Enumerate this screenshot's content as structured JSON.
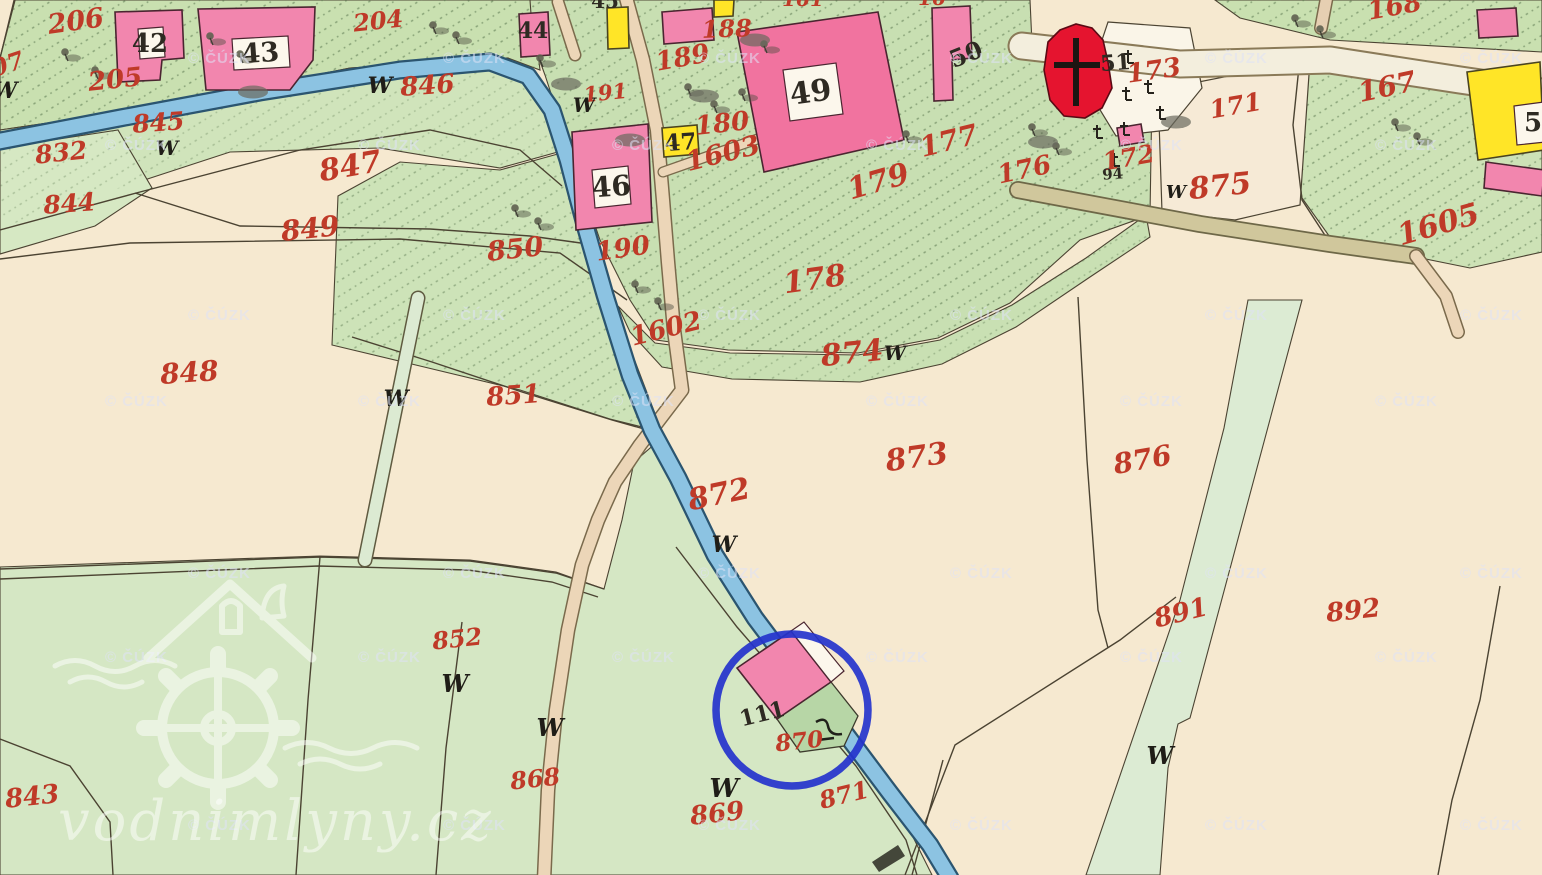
{
  "map": {
    "copyright_text": "© ČÚZK",
    "site_watermark": "vodnimlyny.cz",
    "palette": {
      "field_cream": "#f6e9d0",
      "meadow_green": "#d3e7c2",
      "garden_green": "#c9e0b0",
      "river_blue": "#8cc3e2",
      "road_beige": "#ecd6b8",
      "building_pink": "#f286ae",
      "building_yellow": "#ffe527",
      "church_red": "#e5142f",
      "label_red": "#bf3a28",
      "label_black": "#2e2a22",
      "highlight_blue": "#2433cc"
    },
    "labels": [
      {
        "t": "07",
        "x": 10,
        "y": 72,
        "s": 24,
        "r": -18,
        "c": "r"
      },
      {
        "t": "206",
        "x": 77,
        "y": 30,
        "s": 27,
        "r": -8,
        "c": "r"
      },
      {
        "t": "205",
        "x": 116,
        "y": 88,
        "s": 26,
        "r": -6,
        "c": "r"
      },
      {
        "t": "204",
        "x": 379,
        "y": 29,
        "s": 24,
        "r": -6,
        "c": "r"
      },
      {
        "t": "846",
        "x": 428,
        "y": 94,
        "s": 26,
        "r": -4,
        "c": "r"
      },
      {
        "t": "845",
        "x": 159,
        "y": 131,
        "s": 25,
        "r": -4,
        "c": "r"
      },
      {
        "t": "832",
        "x": 62,
        "y": 161,
        "s": 25,
        "r": -6,
        "c": "r"
      },
      {
        "t": "844",
        "x": 70,
        "y": 212,
        "s": 25,
        "r": -4,
        "c": "r"
      },
      {
        "t": "847",
        "x": 352,
        "y": 176,
        "s": 30,
        "r": -10,
        "c": "r"
      },
      {
        "t": "849",
        "x": 311,
        "y": 238,
        "s": 28,
        "r": -6,
        "c": "r"
      },
      {
        "t": "848",
        "x": 190,
        "y": 382,
        "s": 28,
        "r": -4,
        "c": "r"
      },
      {
        "t": "850",
        "x": 516,
        "y": 258,
        "s": 27,
        "r": -6,
        "c": "r"
      },
      {
        "t": "851",
        "x": 514,
        "y": 404,
        "s": 26,
        "r": -4,
        "c": "r"
      },
      {
        "t": "190",
        "x": 624,
        "y": 257,
        "s": 26,
        "r": -8,
        "c": "r"
      },
      {
        "t": "1602",
        "x": 668,
        "y": 337,
        "s": 26,
        "r": -14,
        "c": "r"
      },
      {
        "t": "189",
        "x": 684,
        "y": 66,
        "s": 26,
        "r": -10,
        "c": "r"
      },
      {
        "t": "191",
        "x": 606,
        "y": 100,
        "s": 21,
        "r": -6,
        "c": "r"
      },
      {
        "t": "188",
        "x": 727,
        "y": 37,
        "s": 24,
        "r": -2,
        "c": "r"
      },
      {
        "t": "180",
        "x": 723,
        "y": 132,
        "s": 26,
        "r": -6,
        "c": "r"
      },
      {
        "t": "1603",
        "x": 725,
        "y": 162,
        "s": 27,
        "r": -14,
        "c": "r"
      },
      {
        "t": "179",
        "x": 881,
        "y": 191,
        "s": 30,
        "r": -16,
        "c": "r"
      },
      {
        "t": "177",
        "x": 951,
        "y": 150,
        "s": 28,
        "r": -14,
        "c": "r"
      },
      {
        "t": "176",
        "x": 1026,
        "y": 178,
        "s": 26,
        "r": -12,
        "c": "r"
      },
      {
        "t": "178",
        "x": 816,
        "y": 289,
        "s": 30,
        "r": -8,
        "c": "r"
      },
      {
        "t": "173",
        "x": 1155,
        "y": 79,
        "s": 26,
        "r": -8,
        "c": "r"
      },
      {
        "t": "172",
        "x": 1130,
        "y": 166,
        "s": 25,
        "r": -10,
        "c": "r"
      },
      {
        "t": "171",
        "x": 1237,
        "y": 114,
        "s": 25,
        "r": -10,
        "c": "r"
      },
      {
        "t": "875",
        "x": 1221,
        "y": 196,
        "s": 30,
        "r": -6,
        "c": "r"
      },
      {
        "t": "167",
        "x": 1389,
        "y": 96,
        "s": 28,
        "r": -12,
        "c": "r"
      },
      {
        "t": "168",
        "x": 1396,
        "y": 15,
        "s": 26,
        "r": -10,
        "c": "r"
      },
      {
        "t": "1605",
        "x": 1441,
        "y": 234,
        "s": 30,
        "r": -16,
        "c": "r"
      },
      {
        "t": "874",
        "x": 853,
        "y": 363,
        "s": 30,
        "r": -6,
        "c": "r"
      },
      {
        "t": "873",
        "x": 918,
        "y": 467,
        "s": 30,
        "r": -8,
        "c": "r"
      },
      {
        "t": "872",
        "x": 721,
        "y": 504,
        "s": 30,
        "r": -12,
        "c": "r"
      },
      {
        "t": "876",
        "x": 1144,
        "y": 469,
        "s": 28,
        "r": -10,
        "c": "r"
      },
      {
        "t": "891",
        "x": 1183,
        "y": 621,
        "s": 26,
        "r": -14,
        "c": "r"
      },
      {
        "t": "892",
        "x": 1354,
        "y": 619,
        "s": 26,
        "r": -6,
        "c": "r"
      },
      {
        "t": "852",
        "x": 458,
        "y": 647,
        "s": 24,
        "r": -6,
        "c": "r"
      },
      {
        "t": "868",
        "x": 536,
        "y": 787,
        "s": 24,
        "r": -6,
        "c": "r"
      },
      {
        "t": "869",
        "x": 718,
        "y": 822,
        "s": 26,
        "r": -6,
        "c": "r"
      },
      {
        "t": "870",
        "x": 800,
        "y": 749,
        "s": 23,
        "r": -6,
        "c": "r"
      },
      {
        "t": "871",
        "x": 846,
        "y": 803,
        "s": 24,
        "r": -14,
        "c": "r"
      },
      {
        "t": "843",
        "x": 33,
        "y": 805,
        "s": 26,
        "r": -6,
        "c": "r"
      },
      {
        "t": "161",
        "x": 803,
        "y": 6,
        "s": 20,
        "r": 0,
        "c": "r"
      },
      {
        "t": "16",
        "x": 932,
        "y": 5,
        "s": 20,
        "r": 0,
        "c": "r"
      },
      {
        "t": "42",
        "x": 150,
        "y": 52,
        "s": 26,
        "r": 0,
        "c": "k"
      },
      {
        "t": "43",
        "x": 261,
        "y": 62,
        "s": 27,
        "r": -4,
        "c": "k"
      },
      {
        "t": "44",
        "x": 533,
        "y": 38,
        "s": 22,
        "r": 0,
        "c": "k"
      },
      {
        "t": "45",
        "x": 605,
        "y": 8,
        "s": 20,
        "r": 0,
        "c": "k"
      },
      {
        "t": "46",
        "x": 612,
        "y": 196,
        "s": 28,
        "r": -4,
        "c": "k"
      },
      {
        "t": "47",
        "x": 681,
        "y": 150,
        "s": 23,
        "r": -4,
        "c": "k"
      },
      {
        "t": "49",
        "x": 812,
        "y": 102,
        "s": 30,
        "r": -8,
        "c": "k"
      },
      {
        "t": "50",
        "x": 969,
        "y": 62,
        "s": 24,
        "r": -22,
        "c": "k"
      },
      {
        "t": "51",
        "x": 1116,
        "y": 70,
        "s": 22,
        "r": -4,
        "c": "k"
      },
      {
        "t": "5",
        "x": 1533,
        "y": 131,
        "s": 26,
        "r": 0,
        "c": "k"
      },
      {
        "t": "94",
        "x": 1113,
        "y": 179,
        "s": 15,
        "r": -4,
        "c": "k"
      },
      {
        "t": "111",
        "x": 764,
        "y": 721,
        "s": 22,
        "r": -14,
        "c": "k"
      },
      {
        "t": "W",
        "x": 5,
        "y": 98,
        "s": 22,
        "r": 0,
        "c": "w"
      },
      {
        "t": "W",
        "x": 167,
        "y": 155,
        "s": 20,
        "r": 0,
        "c": "w"
      },
      {
        "t": "W",
        "x": 380,
        "y": 93,
        "s": 22,
        "r": 0,
        "c": "w"
      },
      {
        "t": "W",
        "x": 584,
        "y": 112,
        "s": 20,
        "r": 0,
        "c": "w"
      },
      {
        "t": "W",
        "x": 396,
        "y": 406,
        "s": 22,
        "r": 0,
        "c": "w"
      },
      {
        "t": "W",
        "x": 895,
        "y": 360,
        "s": 20,
        "r": 0,
        "c": "w"
      },
      {
        "t": "W",
        "x": 1176,
        "y": 198,
        "s": 18,
        "r": 0,
        "c": "w"
      },
      {
        "t": "W",
        "x": 724,
        "y": 552,
        "s": 22,
        "r": 0,
        "c": "w"
      },
      {
        "t": "W",
        "x": 455,
        "y": 692,
        "s": 24,
        "r": 0,
        "c": "w"
      },
      {
        "t": "W",
        "x": 550,
        "y": 736,
        "s": 24,
        "r": 0,
        "c": "w"
      },
      {
        "t": "W",
        "x": 724,
        "y": 797,
        "s": 26,
        "r": 0,
        "c": "w"
      },
      {
        "t": "W",
        "x": 1160,
        "y": 764,
        "s": 24,
        "r": 0,
        "c": "w"
      }
    ],
    "tree_symbols": [
      [
        65,
        52
      ],
      [
        95,
        70
      ],
      [
        210,
        36
      ],
      [
        240,
        54
      ],
      [
        433,
        25
      ],
      [
        456,
        35
      ],
      [
        540,
        58
      ],
      [
        688,
        87
      ],
      [
        714,
        104
      ],
      [
        742,
        92
      ],
      [
        764,
        44
      ],
      [
        906,
        134
      ],
      [
        1295,
        18
      ],
      [
        1320,
        29
      ],
      [
        1395,
        122
      ],
      [
        1417,
        136
      ],
      [
        1032,
        127
      ],
      [
        1056,
        146
      ],
      [
        515,
        208
      ],
      [
        538,
        221
      ],
      [
        635,
        284
      ],
      [
        658,
        301
      ]
    ],
    "smudge_symbols": [
      [
        755,
        40
      ],
      [
        704,
        96
      ],
      [
        566,
        84
      ],
      [
        253,
        92
      ],
      [
        1176,
        122
      ],
      [
        1043,
        142
      ],
      [
        630,
        140
      ]
    ],
    "cemetery_crosses": [
      [
        1128,
        56
      ],
      [
        1148,
        86
      ],
      [
        1126,
        93
      ],
      [
        1160,
        112
      ],
      [
        1124,
        128
      ],
      [
        1097,
        131
      ],
      [
        1114,
        159
      ]
    ],
    "watermark_rows": [
      {
        "y": 63,
        "x": [
          188,
          443,
          698,
          950,
          1205,
          1460
        ]
      },
      {
        "y": 150,
        "x": [
          105,
          358,
          612,
          866,
          1120,
          1375
        ]
      },
      {
        "y": 320,
        "x": [
          188,
          443,
          698,
          950,
          1205,
          1460
        ]
      },
      {
        "y": 406,
        "x": [
          105,
          358,
          612,
          866,
          1120,
          1375
        ]
      },
      {
        "y": 578,
        "x": [
          188,
          443,
          698,
          950,
          1205,
          1460
        ]
      },
      {
        "y": 662,
        "x": [
          105,
          358,
          612,
          866,
          1120,
          1375
        ]
      },
      {
        "y": 830,
        "x": [
          188,
          443,
          698,
          950,
          1205,
          1460
        ]
      }
    ],
    "highlight_circle": {
      "cx": 792,
      "cy": 710,
      "r": 76,
      "color": "#2433cc",
      "stroke_width": 7.5
    }
  }
}
